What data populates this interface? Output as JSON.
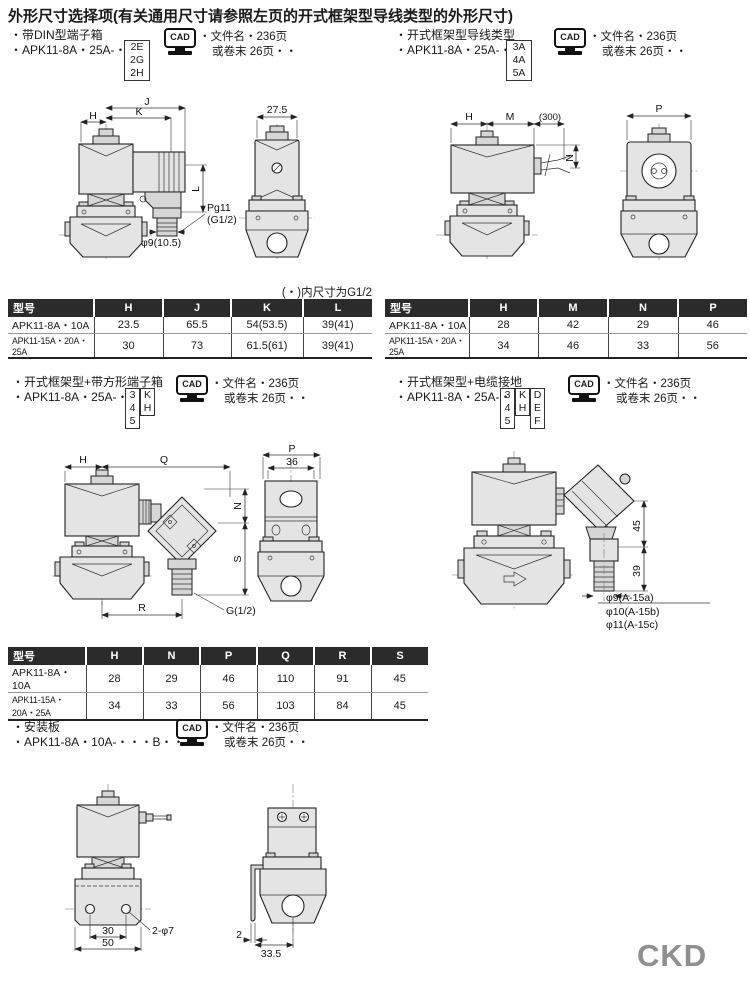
{
  "page": {
    "title": "外形尺寸选择项(有关通用尺寸请参照左页的开式框架型导线类型的外形尺寸)",
    "logo": "CKD"
  },
  "cad": {
    "label": "CAD",
    "file_line1": "・文件名・236页",
    "file_line2": "或卷末 26页・・"
  },
  "sections": {
    "din": {
      "b1": "・带DIN型端子箱",
      "b2": "・APK11-8A・25A-・",
      "opts1": [
        "2E",
        "2G",
        "2H"
      ]
    },
    "lead": {
      "b1": "・开式框架型导线类型",
      "b2": "・APK11-8A・25A-・",
      "opts1": [
        "3A",
        "4A",
        "5A"
      ]
    },
    "sq": {
      "b1": "・开式框架型+带方形端子箱",
      "b2": "・APK11-8A・25A-・",
      "opts1": [
        "3",
        "4",
        "5"
      ],
      "opts2": [
        "K",
        "H"
      ]
    },
    "cg": {
      "b1": "・开式框架型+电缆接地",
      "b2": "・APK11-8A・25A-・",
      "opts1": [
        "3",
        "4",
        "5"
      ],
      "opts2": [
        "K",
        "H"
      ],
      "opts3": [
        "D",
        "E",
        "F"
      ]
    },
    "mp": {
      "b1": "・安装板",
      "b2": "・APK11-8A・10A-・・・B・・"
    }
  },
  "note_g12": "(・)内尺寸为G1/2",
  "tables": {
    "t1": {
      "headers": [
        "型号",
        "H",
        "J",
        "K",
        "L"
      ],
      "rows": [
        [
          "APK11-8A・10A",
          "23.5",
          "65.5",
          "54(53.5)",
          "39(41)"
        ],
        [
          "APK11-15A・20A・25A",
          "30",
          "73",
          "61.5(61)",
          "39(41)"
        ]
      ]
    },
    "t2": {
      "headers": [
        "型号",
        "H",
        "M",
        "N",
        "P"
      ],
      "rows": [
        [
          "APK11-8A・10A",
          "28",
          "42",
          "29",
          "46"
        ],
        [
          "APK11-15A・20A・25A",
          "34",
          "46",
          "33",
          "56"
        ]
      ]
    },
    "t3": {
      "headers": [
        "型号",
        "H",
        "N",
        "P",
        "Q",
        "R",
        "S"
      ],
      "rows": [
        [
          "APK11-8A・10A",
          "28",
          "29",
          "46",
          "110",
          "91",
          "45"
        ],
        [
          "APK11-15A・20A・25A",
          "34",
          "33",
          "56",
          "103",
          "84",
          "45"
        ]
      ]
    }
  },
  "dims": {
    "d1": {
      "H": "H",
      "J": "J",
      "K": "K",
      "L": "L",
      "w275": "27.5",
      "pg": "Pg11",
      "pg2": "(G1/2)",
      "hole": "φ9(10.5)"
    },
    "d2": {
      "H": "H",
      "M": "M",
      "brk": "(300)",
      "N": "N",
      "P": "P"
    },
    "d3": {
      "H": "H",
      "Q": "Q",
      "N": "N",
      "S": "S",
      "R": "R",
      "g": "G(1/2)",
      "P": "P",
      "w36": "36"
    },
    "d4": {
      "v45": "45",
      "v39": "39",
      "n1": "φ9(A-15a)",
      "n2": "φ10(A-15b)",
      "n3": "φ11(A-15c)"
    },
    "d5": {
      "w30": "30",
      "w50": "50",
      "holes": "2-φ7",
      "t2": "2",
      "w335": "33.5"
    }
  }
}
